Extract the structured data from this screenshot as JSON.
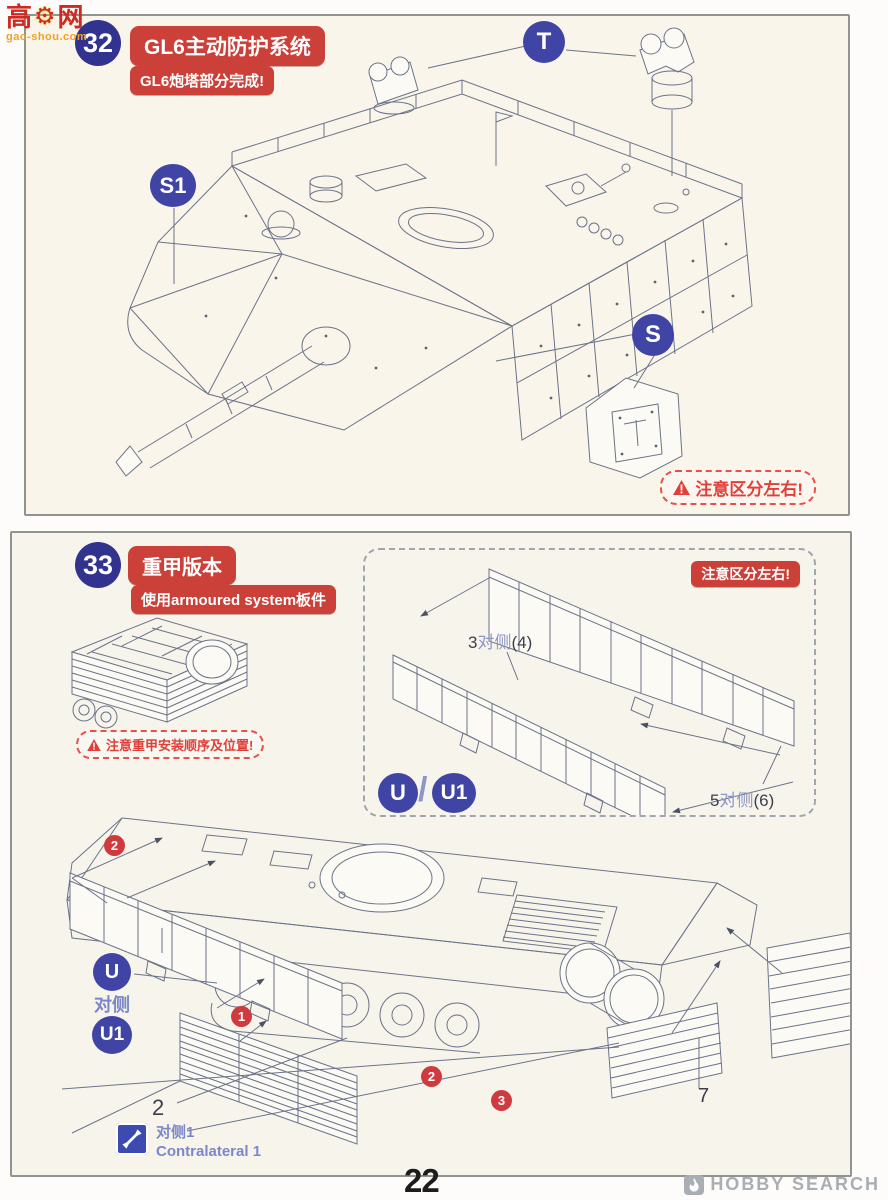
{
  "colors": {
    "badge_navy": "#32328f",
    "callout_blue": "#3f44a5",
    "title_red": "#cb4038",
    "warning_red": "#e0403a",
    "number_circle_red": "#cf3a3f",
    "label_blue": "#7b87c8",
    "line_art_gray": "#6b7389",
    "panel_bg_top": "#faf5eb",
    "panel_bg_bottom": "#f7f4ec",
    "panel_border": "#8f948e"
  },
  "icons": {
    "warning": "warning-triangle-icon",
    "contralateral": "double-arrow-icon",
    "hobbysearch": "flame-icon",
    "gaoshou": "gear-icon"
  },
  "watermarks": {
    "gaoshou": {
      "cn_prefix": "高",
      "icon_glyph": "⚙",
      "cn_suffix": "网",
      "domain": "gao-shou.com"
    },
    "hobbysearch": {
      "label": "HOBBY SEARCH"
    }
  },
  "footer": {
    "page_number": "22"
  },
  "step32": {
    "number": "32",
    "title": "GL6主动防护系统",
    "subtitle": "GL6炮塔部分完成!",
    "callouts": {
      "t": "T",
      "s1": "S1",
      "s": "S"
    },
    "warning": "注意区分左右!"
  },
  "step33": {
    "number": "33",
    "title": "重甲版本",
    "subtitle": "使用armoured system板件",
    "assembly_warning": "注意重甲安装顺序及位置!",
    "inset": {
      "warning": "注意区分左右!",
      "part_label_3": {
        "num": "3",
        "side": "对侧",
        "qty": "(4)"
      },
      "part_label_5": {
        "num": "5",
        "side": "对侧",
        "qty": "(6)"
      },
      "callout_u": "U",
      "separator": "/",
      "callout_u1": "U1"
    },
    "callouts": {
      "u": "U",
      "u_side": "对侧",
      "u1": "U1",
      "step1": "1",
      "step2_top": "2",
      "step2_bottom": "2",
      "step3": "3",
      "part2": "2",
      "part7": "7"
    },
    "contralateral": {
      "zh": "对侧1",
      "en": "Contralateral 1"
    }
  }
}
